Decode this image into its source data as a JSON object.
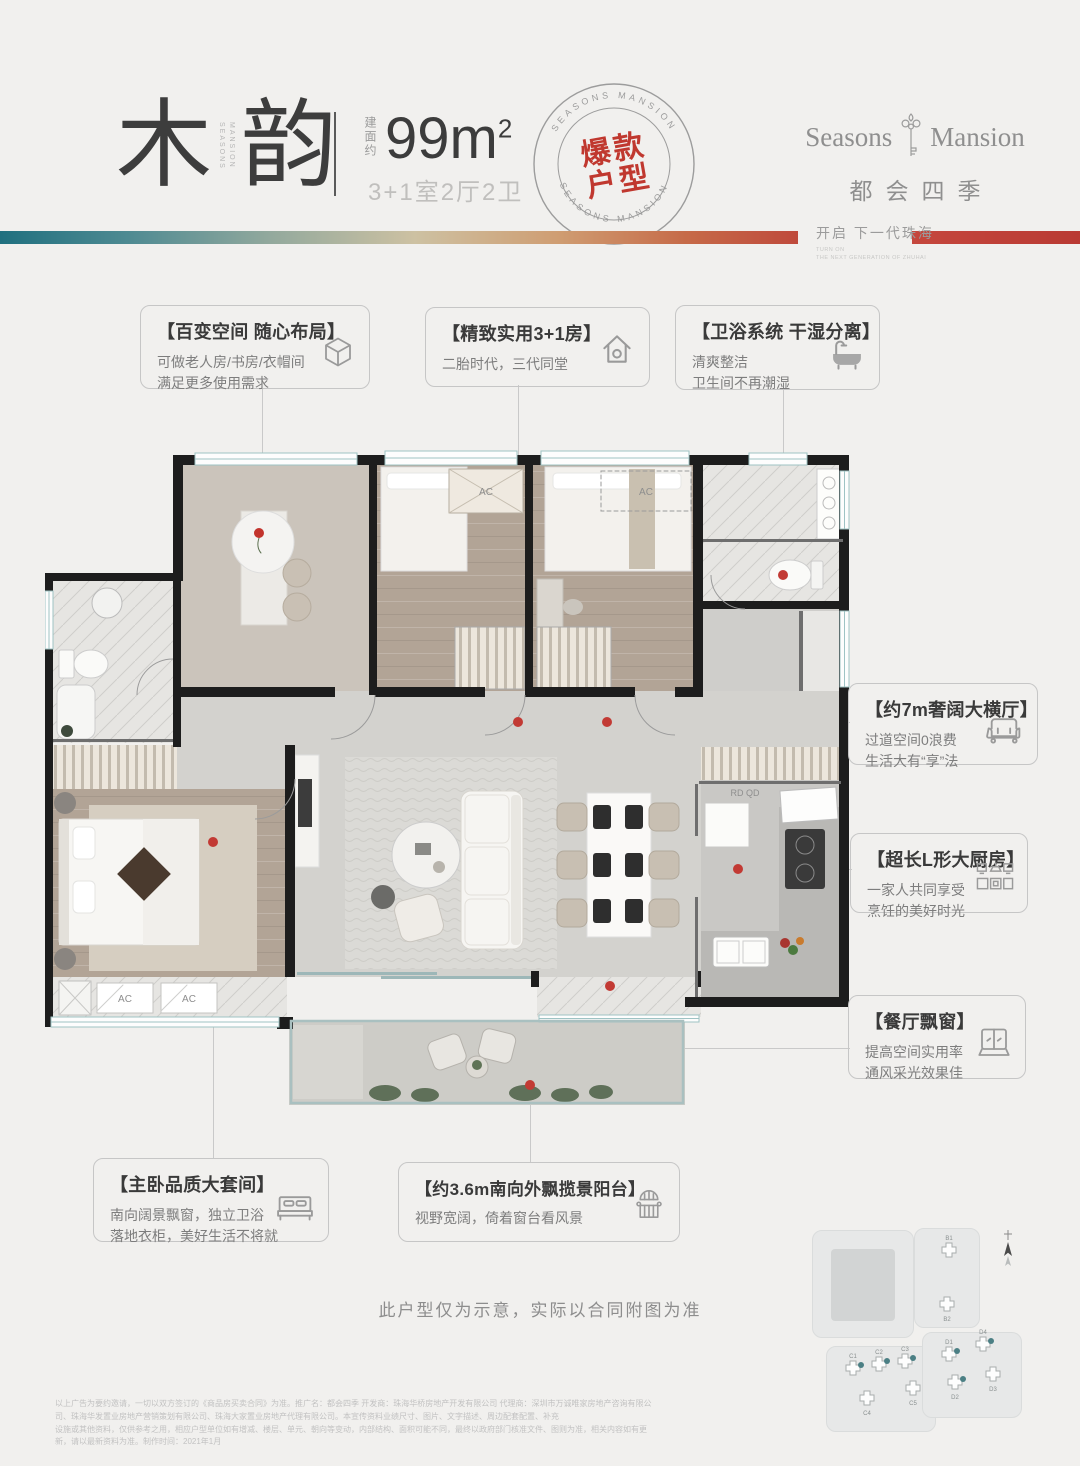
{
  "header": {
    "title_char1": "木",
    "title_char2": "韵",
    "title_side1": "SEASONS",
    "title_side2": "MANSION",
    "area_label": "建面约",
    "area_value": "99m",
    "area_exp": "2",
    "spec": "3+1室2厅2卫",
    "stamp": {
      "arc_top": "SEASONS MANSION",
      "arc_bottom": "SEASONS MANSION",
      "word1": "爆款",
      "word2": "户型",
      "color": "#c0382f"
    },
    "brand": {
      "en1": "Seasons",
      "en2": "Mansion",
      "cn": "都会四季"
    },
    "slogan": {
      "cn": "开启 下一代珠海",
      "en1": "TURN ON",
      "en2": "THE NEXT GENERATION OF ZHUHAI"
    }
  },
  "callouts": [
    {
      "title": "【百变空间 随心布局】",
      "line1": "可做老人房/书房/衣帽间",
      "line2": "满足更多使用需求",
      "icon": "cube-icon"
    },
    {
      "title": "【精致实用3+1房】",
      "line1": "二胎时代，三代同堂",
      "line2": "",
      "icon": "house-icon"
    },
    {
      "title": "【卫浴系统 干湿分离】",
      "line1": "清爽整洁",
      "line2": "卫生间不再潮湿",
      "icon": "bathtub-icon"
    },
    {
      "title": "【约7m奢阔大横厅】",
      "line1": "过道空间0浪费",
      "line2": "生活大有“享”法",
      "icon": "sofa-icon"
    },
    {
      "title": "【超长L形大厨房】",
      "line1": "一家人共同享受",
      "line2": "烹饪的美好时光",
      "icon": "kitchen-icon"
    },
    {
      "title": "【餐厅飘窗】",
      "line1": "提高空间实用率",
      "line2": "通风采光效果佳",
      "icon": "bay-window-icon"
    },
    {
      "title": "【主卧品质大套间】",
      "line1": "南向阔景飘窗，独立卫浴",
      "line2": "落地衣柜，美好生活不将就",
      "icon": "bed-icon"
    },
    {
      "title": "【约3.6m南向外飘揽景阳台】",
      "line1": "视野宽阔，倚着窗台看风景",
      "line2": "",
      "icon": "balcony-icon"
    }
  ],
  "plan": {
    "ac": "AC",
    "rd": "RD QD",
    "note": "此户型仅为示意，实际以合同附图为准"
  },
  "sitemap": {
    "buildings": [
      {
        "label": "B1"
      },
      {
        "label": "B2"
      },
      {
        "label": "C1"
      },
      {
        "label": "C2"
      },
      {
        "label": "C3"
      },
      {
        "label": "C4"
      },
      {
        "label": "C5"
      },
      {
        "label": "D1"
      },
      {
        "label": "D2"
      },
      {
        "label": "D3"
      },
      {
        "label": "D4"
      }
    ]
  },
  "footer": {
    "line1": "以上广告为要约邀请，一切以双方签订的《商品房买卖合同》为准。推广名：都会四季 开发商：珠海华桥房地产开发有限公司 代理商：深圳市万诚唯家房地产咨询有限公司、珠海华发置业房地产营销策划有限公司、珠海大家置业房地产代理有限公司。本宣传资料业绩尺寸、图片、文字描述、周边配套配置、补充",
    "line2": "设施或其他资料，仅供参考之用，相应户型单位如有增减、楼层、单元、朝向等变动，内部结构、面积可能不同，最终以政府部门核准文件、图则为准，相关内容如有更新，请以最新资料为准。制作时间：2021年1月"
  }
}
